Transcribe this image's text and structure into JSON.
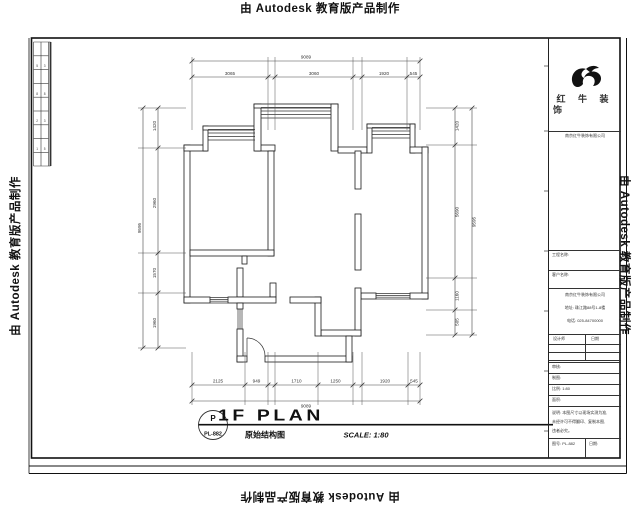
{
  "watermark": {
    "text": "由 Autodesk 教育版产品制作"
  },
  "sheet": {
    "revision_strip_cells": [
      "5",
      "3",
      "8",
      "8",
      "2",
      "3",
      "1",
      "5"
    ]
  },
  "plan": {
    "title": "1F PLAN",
    "scale_label": "SCALE: 1:80",
    "drawing_name": "原始结构图",
    "tag_letter": "P",
    "tag_number": "PL-882",
    "dims": {
      "top": {
        "overall": "9089",
        "segments": [
          "3065",
          "3060",
          "1920",
          "545"
        ]
      },
      "bottom": {
        "overall": "9089",
        "segments": [
          "2125",
          "949",
          "1710",
          "1250",
          "1920",
          "545"
        ]
      },
      "left": {
        "overall": "9595",
        "segments": [
          "1420",
          "2960",
          "1570",
          "1960"
        ]
      },
      "right": {
        "overall": "9595",
        "segments": [
          "1420",
          "5690",
          "1160",
          "505"
        ]
      }
    }
  },
  "title_block": {
    "brand_line1": "红 牛 装",
    "brand_line2": "饰",
    "brand_sub": "南京红牛装饰有限公司",
    "row_project_label": "工程名称:",
    "row_client_label": "客户名称:",
    "company_lines": [
      "南京红牛装饰有限公司",
      "地址: 珠江路88号1-8楼",
      "电话: 025-84700000"
    ],
    "table_header_left": "设计师",
    "table_header_right": "日期",
    "rows": [
      "审核:",
      "制图:",
      "比例: 1:80",
      "面积:"
    ],
    "notes_lines": [
      "说明: 本图尺寸以现场实测为准,",
      "未经许可不得翻印、复制本图,",
      "违者必究。"
    ],
    "bottom_left": "图号: PL-882",
    "bottom_right": "日期:"
  },
  "colors": {
    "ink": "#1a1a1a",
    "dim_line": "#555555"
  }
}
